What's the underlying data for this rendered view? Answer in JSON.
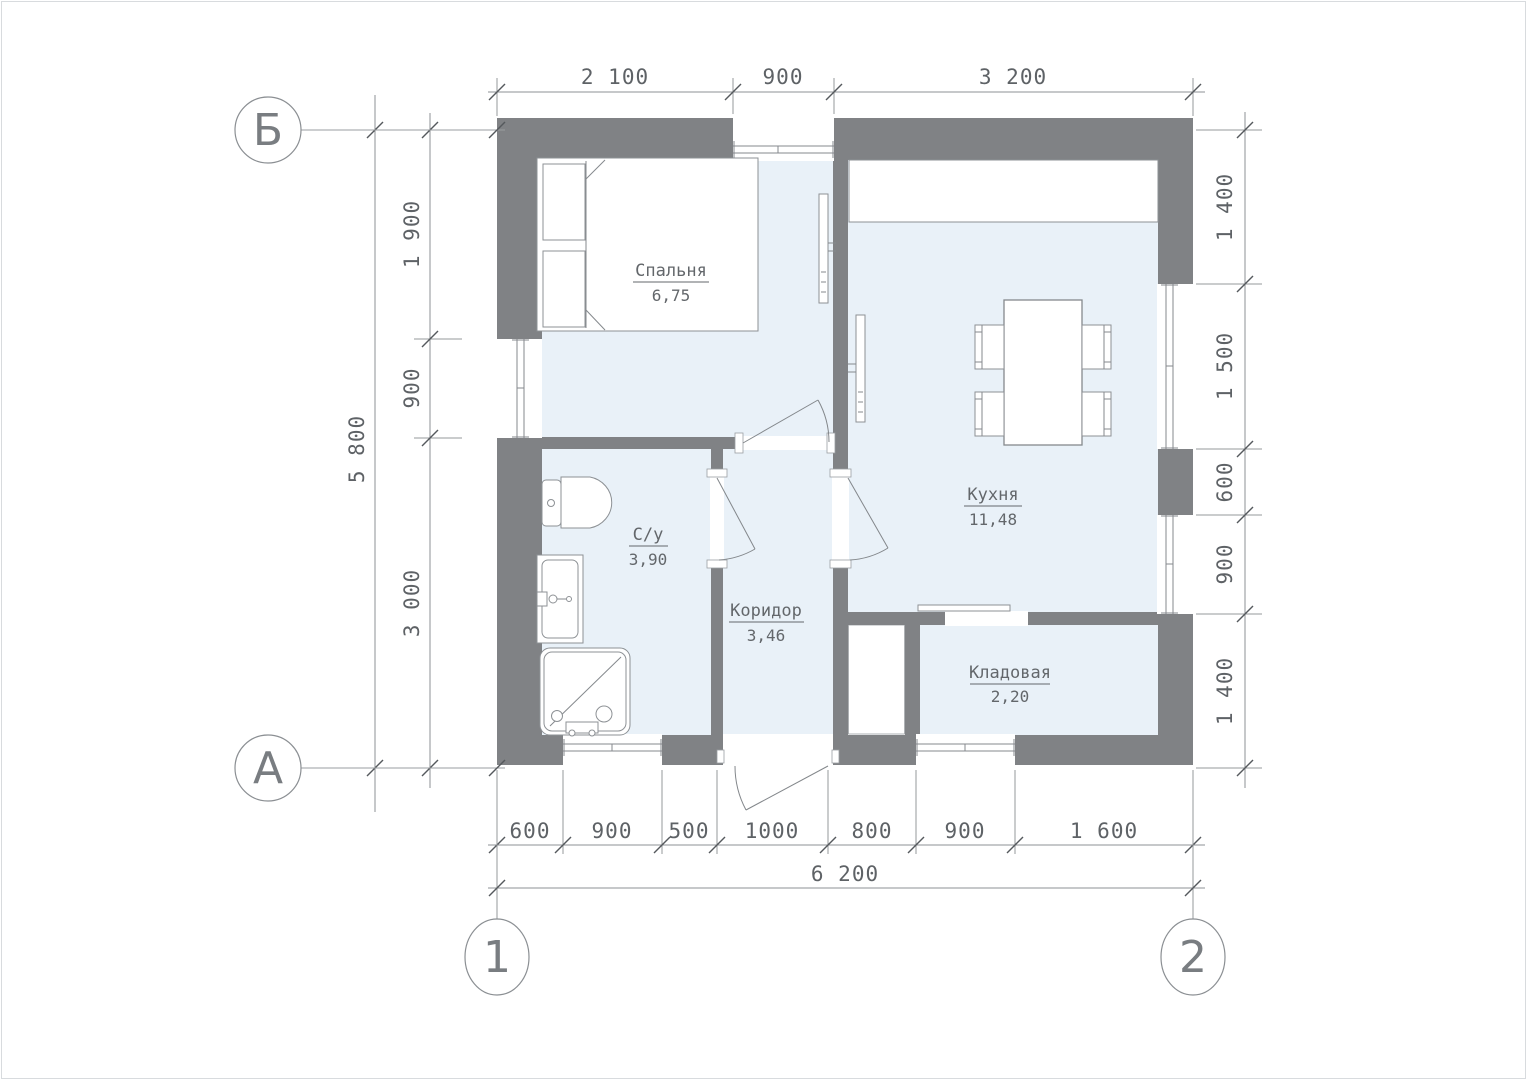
{
  "drawing": {
    "type": "floor-plan",
    "colors": {
      "wall": "#808285",
      "floor": "#e9f1f8",
      "line": "#85898d",
      "text": "#5e6266",
      "background": "#ffffff"
    }
  },
  "grid": {
    "row_top": "Б",
    "row_bottom": "А",
    "col_left": "1",
    "col_right": "2"
  },
  "rooms": {
    "bedroom": {
      "name": "Спальня",
      "area": "6,75"
    },
    "kitchen": {
      "name": "Кухня",
      "area": "11,48"
    },
    "bathroom": {
      "name": "С/у",
      "area": "3,90"
    },
    "corridor": {
      "name": "Коридор",
      "area": "3,46"
    },
    "storage": {
      "name": "Кладовая",
      "area": "2,20"
    }
  },
  "dimensions": {
    "top": [
      "2 100",
      "900",
      "3 200"
    ],
    "bottom": [
      "600",
      "900",
      "500",
      "1000",
      "800",
      "900",
      "1 600"
    ],
    "bottom_total": "6 200",
    "left": [
      "1 900",
      "900",
      "3 000"
    ],
    "left_total": "5 800",
    "right": [
      "1 400",
      "1 500",
      "600",
      "900",
      "1 400"
    ]
  }
}
